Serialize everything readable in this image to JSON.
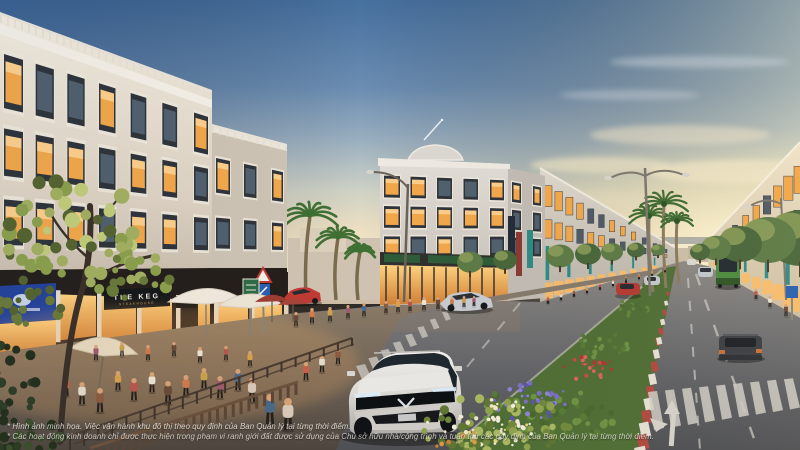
{
  "signs": {
    "keg_title": "THE KEG",
    "keg_subtitle": "STEAKHOUSE"
  },
  "disclaimer": {
    "line1": "* Hình ảnh minh họa. Việc vận hành khu đô thị theo quy định của Ban Quản lý tại từng thời điểm.",
    "line2": "* Các hoạt động kinh doanh chỉ được thực hiện trong phạm vi ranh giới đất được sử dụng của Chủ sở hữu nhà/công trình và tuân thủ các quy định của Ban Quản lý tại từng thời điểm."
  },
  "palette": {
    "sky_top": "#46709f",
    "sky_horizon": "#f8eecb",
    "sunset_glow": "#fdf3cd",
    "building_cream": "#ece5d8",
    "building_grey": "#d9d5cf",
    "window_glow": "#f2a74a",
    "storefront_glow": "#ffbb63",
    "road_asphalt": "#636468",
    "marking_white": "#d6d3cb",
    "median_curb_red": "#b04a40",
    "banner_teal": "#2e8b84",
    "awning_green": "#2e5c38",
    "keg_sign_black": "#17181a",
    "shop_sign_blue": "#24439a",
    "bus_green": "#4d8a3f",
    "bus_roof_yellow": "#d7bb45",
    "foliage_green": "#5d7a46",
    "palm_green": "#3f6b31",
    "flower_purple": "#7a6fc0",
    "suv_white": "#e4e2de"
  }
}
